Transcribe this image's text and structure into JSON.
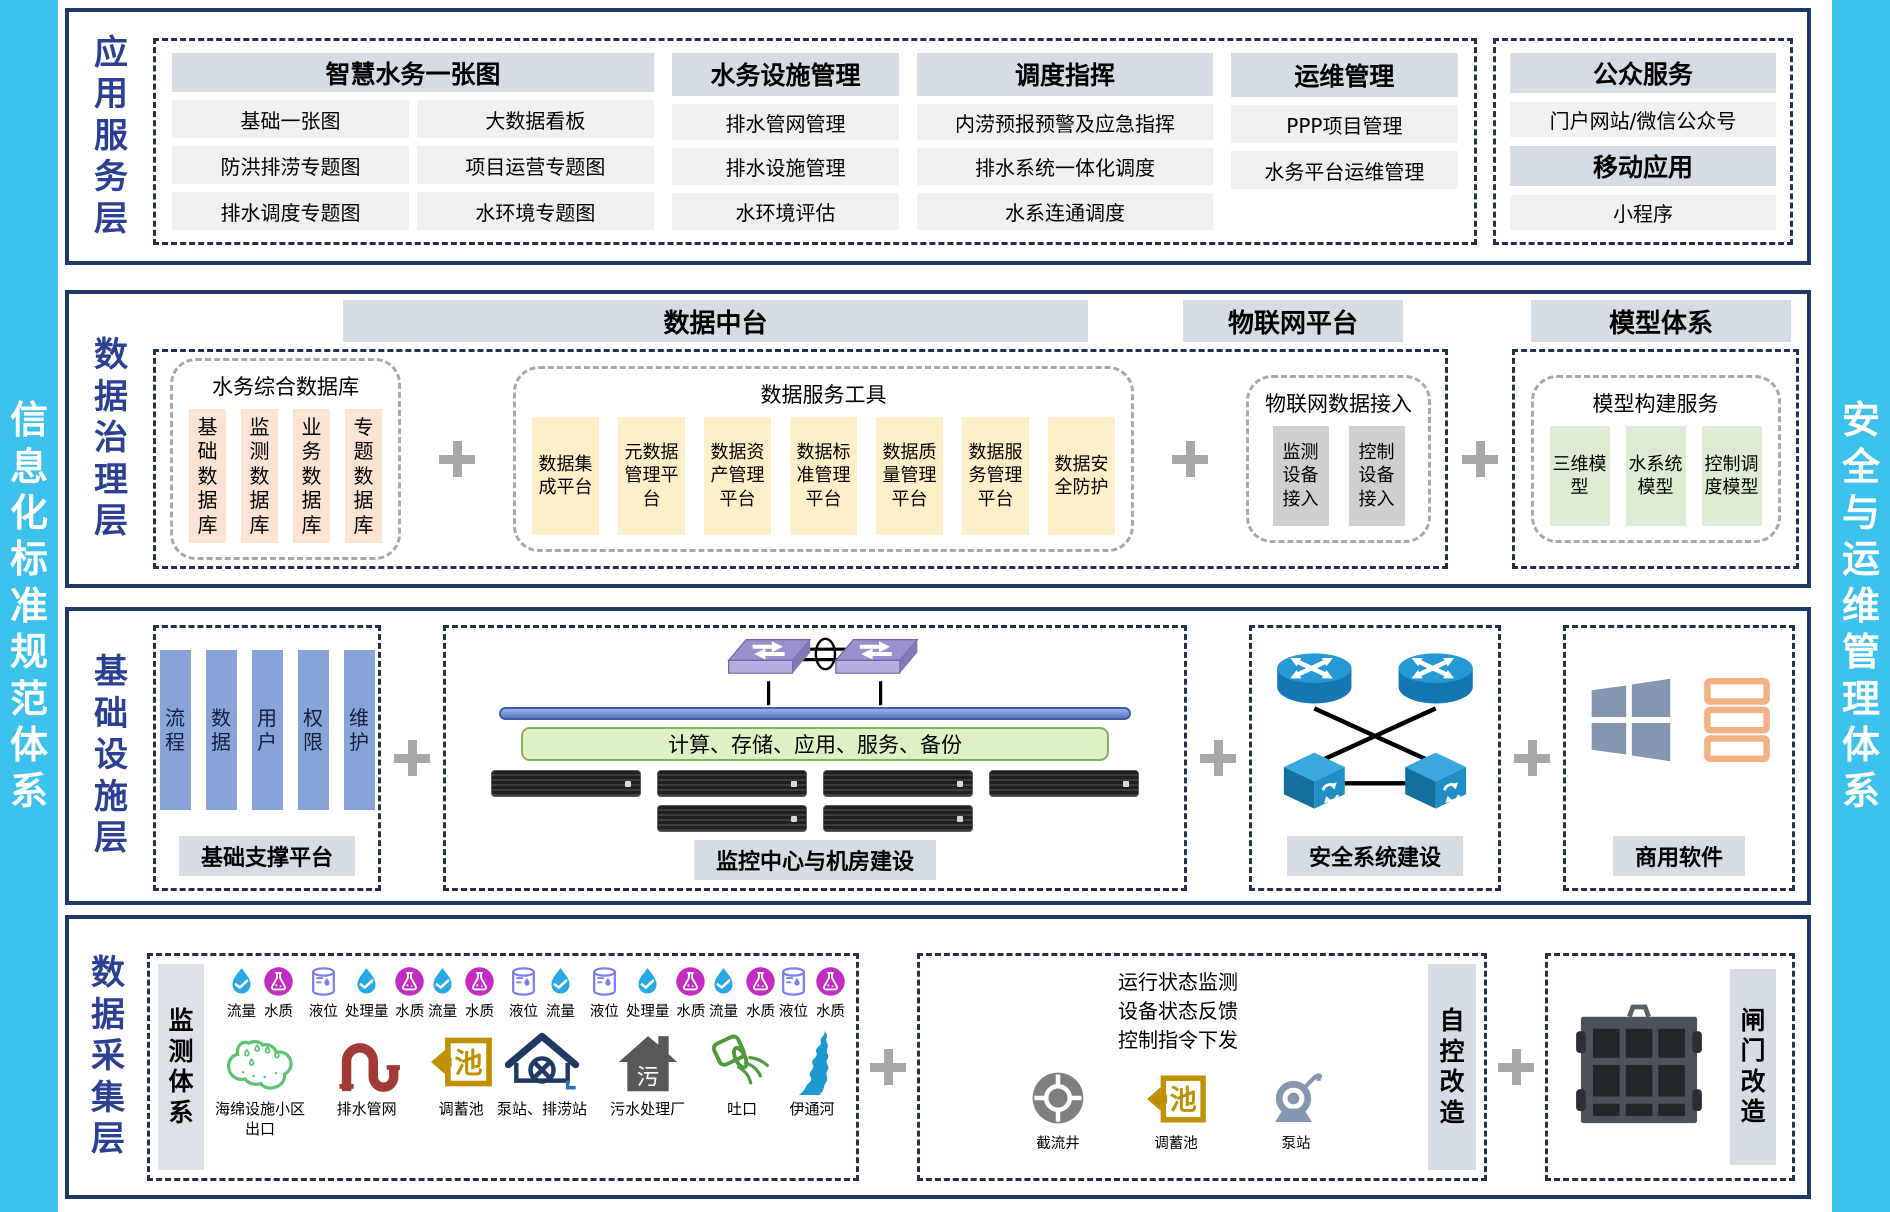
{
  "sidebars": {
    "left": "信息化标准规范体系",
    "right": "安全与运维管理体系"
  },
  "colors": {
    "accent_cyan": "#3cc1ec",
    "panel_border": "#1f3864",
    "layer_label_blue": "#2b3f93",
    "header_bg": "#d6dce4",
    "item_bg": "#f0f0f0",
    "db_box": "#fbe3d3",
    "tool_box": "#fdf0c8",
    "iot_box": "#d1cece",
    "model_box": "#dcebd1",
    "support_bar": "#87a3d8",
    "plus_gray": "#a8a8a8"
  },
  "app": {
    "label": "应用服务层",
    "col1": {
      "header": "智慧水务一张图",
      "items": [
        "基础一张图",
        "大数据看板",
        "防洪排涝专题图",
        "项目运营专题图",
        "排水调度专题图",
        "水环境专题图"
      ]
    },
    "col2": {
      "header": "水务设施管理",
      "items": [
        "排水管网管理",
        "排水设施管理",
        "水环境评估"
      ]
    },
    "col3": {
      "header": "调度指挥",
      "items": [
        "内涝预报预警及应急指挥",
        "排水系统一体化调度",
        "水系连通调度"
      ]
    },
    "col4": {
      "header": "运维管理",
      "items": [
        "PPP项目管理",
        "水务平台运维管理"
      ]
    },
    "pub": {
      "header": "公众服务",
      "item": "门户网站/微信公众号",
      "header2": "移动应用",
      "item2": "小程序"
    }
  },
  "gov": {
    "label": "数据治理层",
    "headers": {
      "mid": "数据中台",
      "iot": "物联网平台",
      "model": "模型体系"
    },
    "db": {
      "title": "水务综合数据库",
      "items": [
        "基础数据库",
        "监测数据库",
        "业务数据库",
        "专题数据库"
      ]
    },
    "tools": {
      "title": "数据服务工具",
      "items": [
        "数据集成平台",
        "元数据管理平台",
        "数据资产管理平台",
        "数据标准管理平台",
        "数据质量管理平台",
        "数据服务管理平台",
        "数据安全防护"
      ]
    },
    "iot": {
      "title": "物联网数据接入",
      "items": [
        "监测设备接入",
        "控制设备接入"
      ]
    },
    "model": {
      "title": "模型构建服务",
      "items": [
        "三维模型",
        "水系统模型",
        "控制调度模型"
      ]
    }
  },
  "infra": {
    "label": "基础设施层",
    "support": {
      "bars": [
        "流程",
        "数据",
        "用户",
        "权限",
        "维护"
      ],
      "caption": "基础支撑平台"
    },
    "dc": {
      "green_bar": "计算、存储、应用、服务、备份",
      "caption": "监控中心与机房建设"
    },
    "sec": {
      "caption": "安全系统建设"
    },
    "sw": {
      "caption": "商用软件"
    }
  },
  "collect": {
    "label": "数据采集层",
    "monitor_title": "监测体系",
    "groups": [
      {
        "facility": "海绵设施小区出口",
        "icon": "sponge-facility-icon",
        "sensors": [
          {
            "kind": "flow",
            "label": "流量"
          },
          {
            "kind": "quality",
            "label": "水质"
          }
        ]
      },
      {
        "facility": "排水管网",
        "icon": "pipe-network-icon",
        "sensors": [
          {
            "kind": "level",
            "label": "液位"
          },
          {
            "kind": "flow",
            "label": "处理量"
          },
          {
            "kind": "quality",
            "label": "水质"
          }
        ]
      },
      {
        "facility": "调蓄池",
        "icon": "storage-tank-icon",
        "sensors": [
          {
            "kind": "flow",
            "label": "流量"
          },
          {
            "kind": "quality",
            "label": "水质"
          }
        ]
      },
      {
        "facility": "泵站、排涝站",
        "icon": "pump-station-icon",
        "sensors": [
          {
            "kind": "level",
            "label": "液位"
          },
          {
            "kind": "flow",
            "label": "流量"
          }
        ]
      },
      {
        "facility": "污水处理厂",
        "icon": "sewage-plant-icon",
        "sensors": [
          {
            "kind": "level",
            "label": "液位"
          },
          {
            "kind": "flow",
            "label": "处理量"
          },
          {
            "kind": "quality",
            "label": "水质"
          }
        ]
      },
      {
        "facility": "吐口",
        "icon": "outlet-icon",
        "sensors": [
          {
            "kind": "flow",
            "label": "流量"
          },
          {
            "kind": "quality",
            "label": "水质"
          }
        ]
      },
      {
        "facility": "伊通河",
        "icon": "river-icon",
        "sensors": [
          {
            "kind": "level",
            "label": "液位"
          },
          {
            "kind": "quality",
            "label": "水质"
          }
        ]
      }
    ],
    "auto": {
      "lines": [
        "运行状态监测",
        "设备状态反馈",
        "控制指令下发"
      ],
      "items": [
        {
          "label": "截流井",
          "icon": "intercept-well-icon"
        },
        {
          "label": "调蓄池",
          "icon": "storage-tank-icon"
        },
        {
          "label": "泵站",
          "icon": "pump-icon"
        }
      ],
      "title": "自控改造"
    },
    "gate": {
      "title": "闸门改造"
    }
  }
}
